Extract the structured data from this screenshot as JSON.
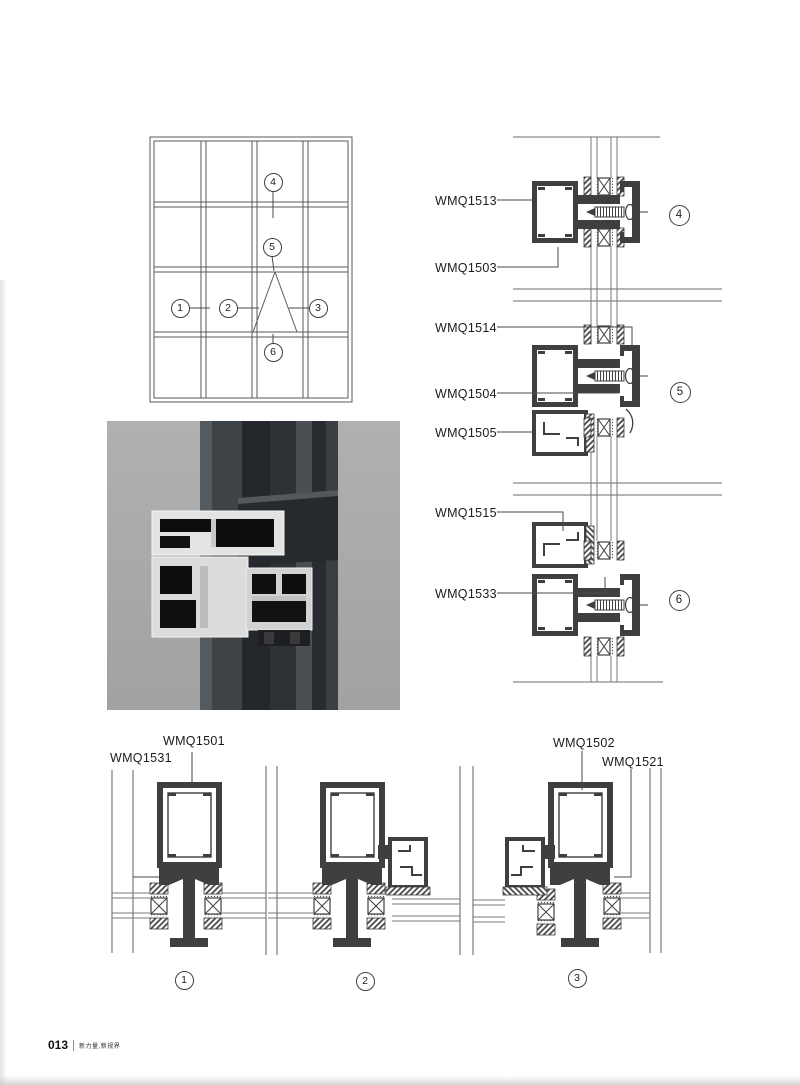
{
  "labels": {
    "wmq1513": "WMQ1513",
    "wmq1503": "WMQ1503",
    "wmq1514": "WMQ1514",
    "wmq1504": "WMQ1504",
    "wmq1505": "WMQ1505",
    "wmq1515": "WMQ1515",
    "wmq1533": "WMQ1533",
    "wmq1501": "WMQ1501",
    "wmq1531": "WMQ1531",
    "wmq1502": "WMQ1502",
    "wmq1521": "WMQ1521"
  },
  "callouts": {
    "c1": "1",
    "c2": "2",
    "c3": "3",
    "c4": "4",
    "c5": "5",
    "c6": "6"
  },
  "footer": {
    "page_number": "013",
    "slogan": "新力量,新视界"
  },
  "colors": {
    "profile_line": "#3f3f3f",
    "glass_line": "#7a7a7a",
    "photo_background": "#a8a8a8",
    "photo_frame_dark": "#2c3034"
  }
}
